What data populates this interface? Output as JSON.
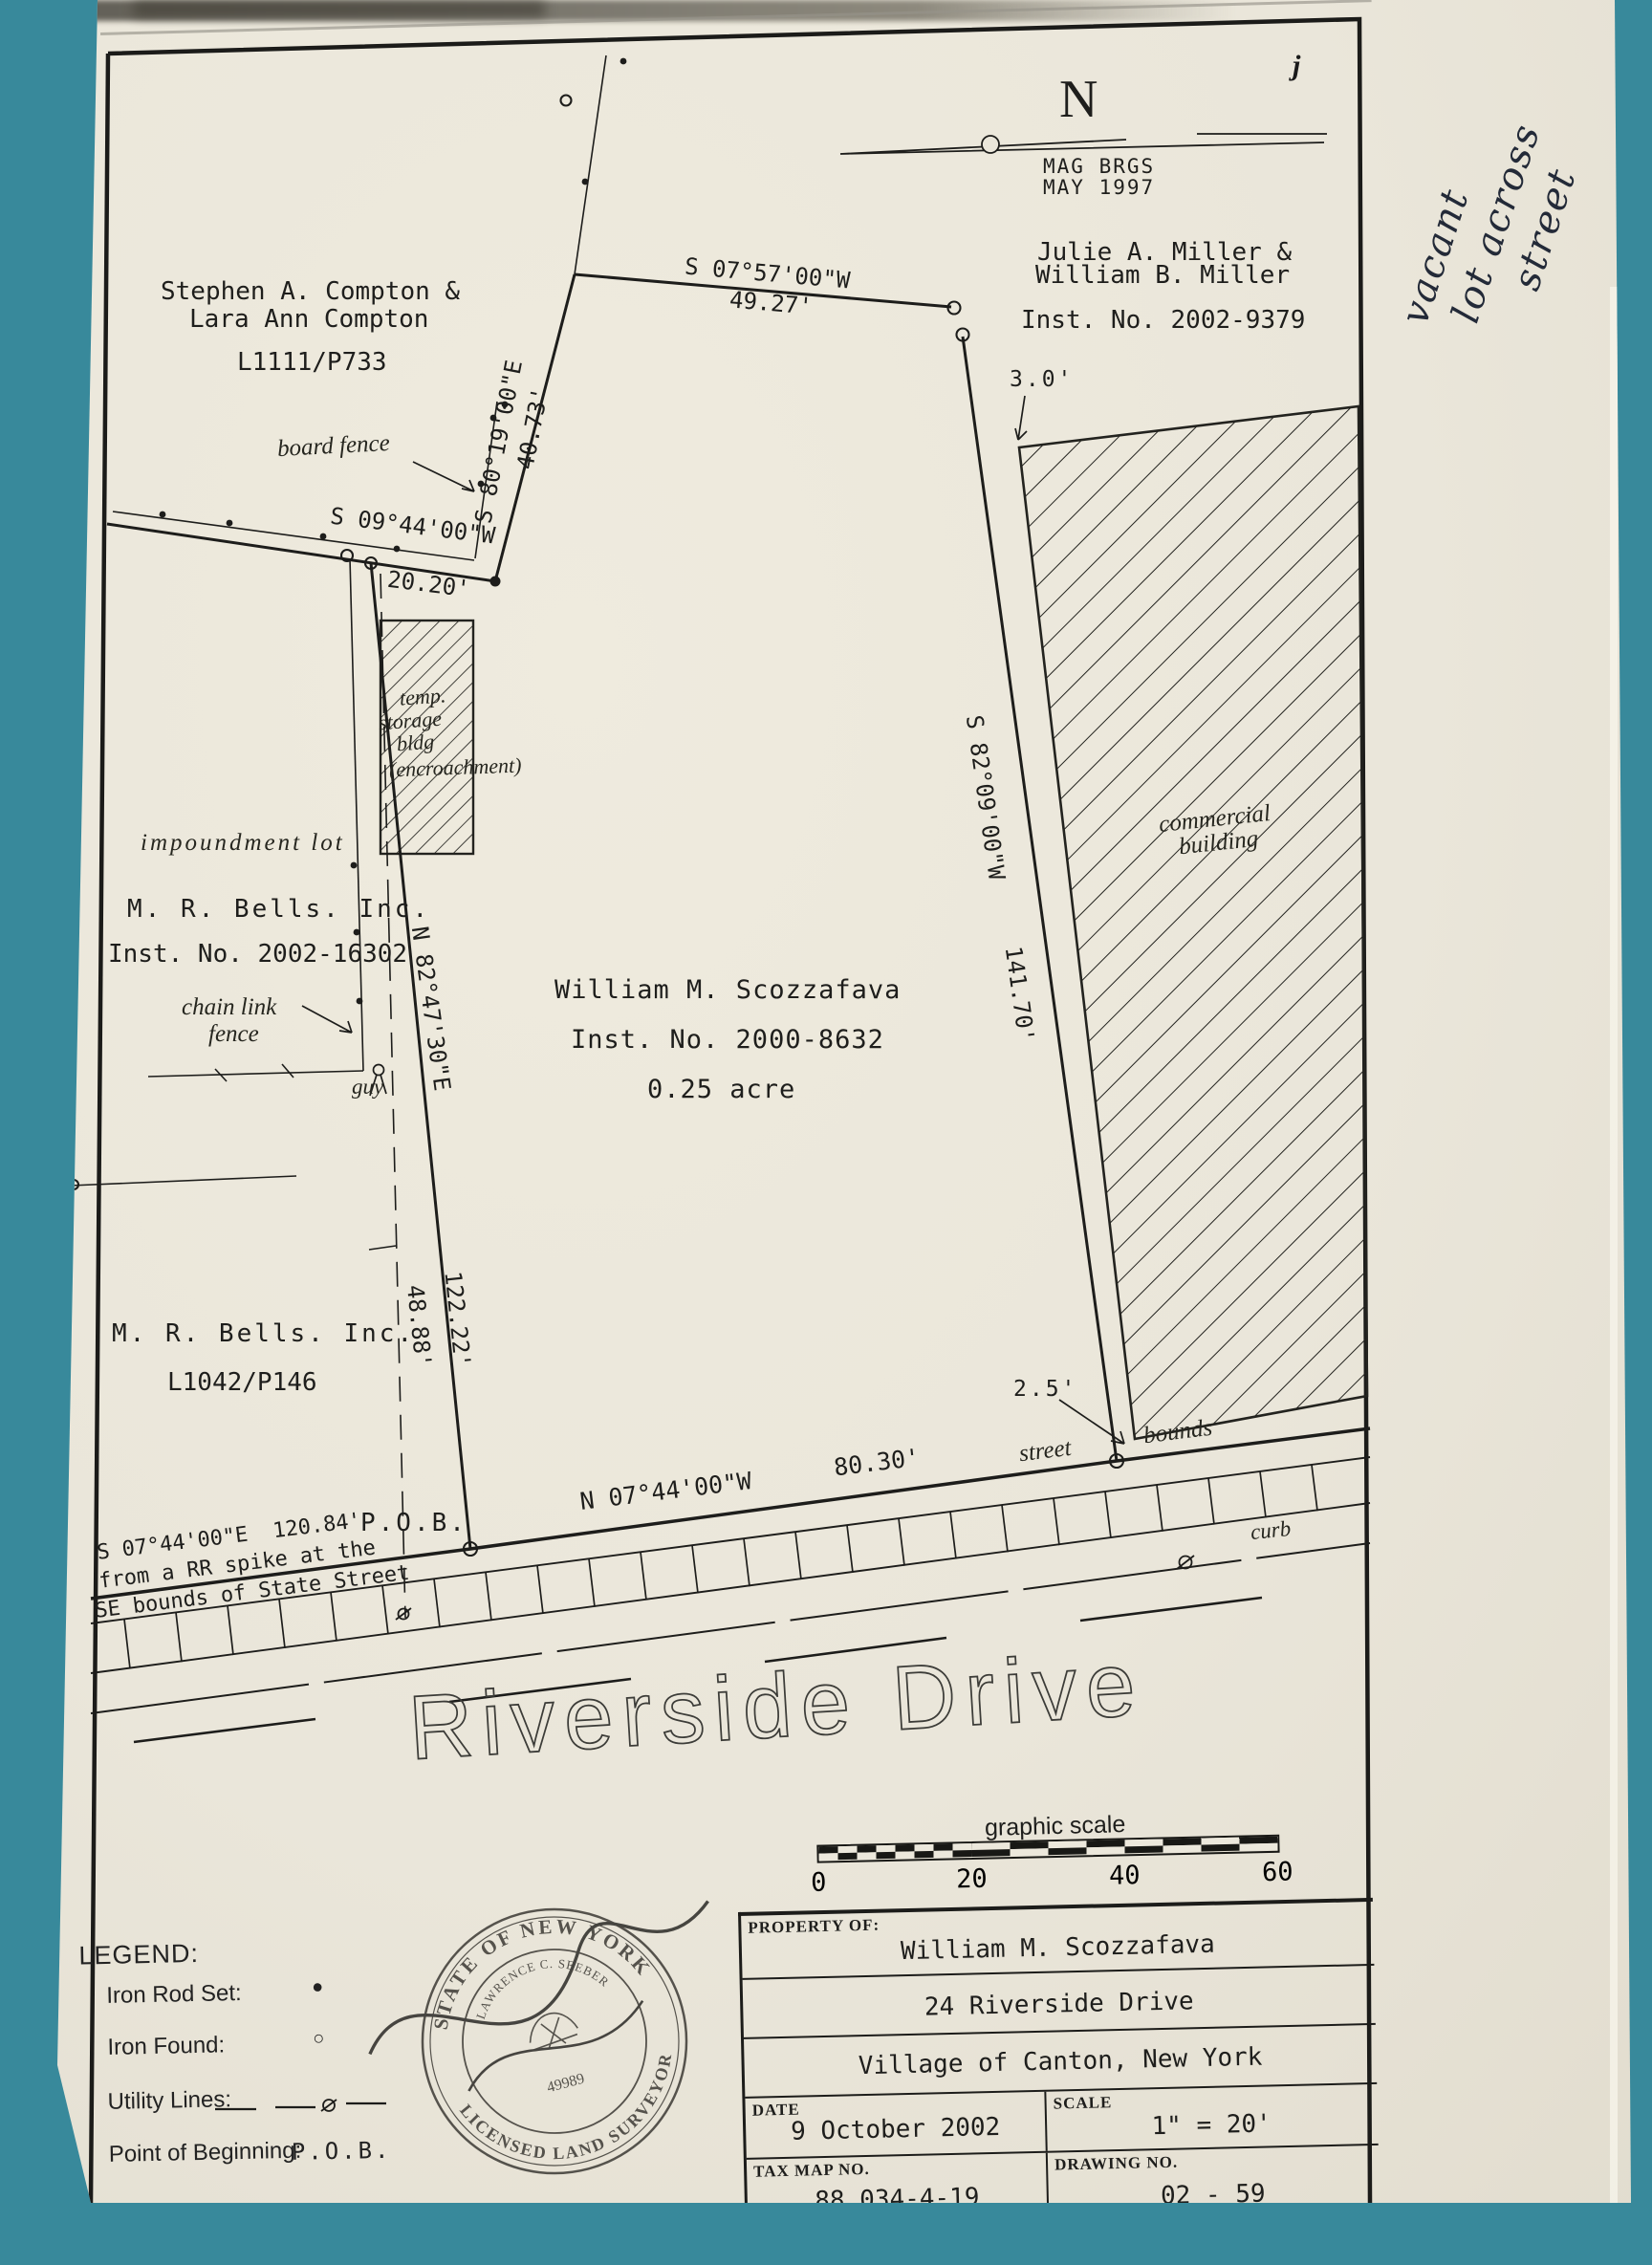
{
  "north": {
    "letter": "N",
    "mag_line1": "MAG BRGS",
    "mag_line2": "MAY 1997"
  },
  "parcels": {
    "compton": {
      "line1": "Stephen A. Compton &",
      "line2": "Lara Ann Compton",
      "deed": "L1111/P733"
    },
    "miller": {
      "line1": "Julie A. Miller &",
      "line2": "William B. Miller",
      "inst": "Inst. No. 2002-9379"
    },
    "bells_north": {
      "label": "impoundment lot",
      "name": "M. R. Bells. Inc.",
      "inst": "Inst. No. 2002-16302"
    },
    "bells_south": {
      "name": "M. R. Bells. Inc.",
      "deed": "L1042/P146"
    },
    "subject": {
      "owner": "William M. Scozzafava",
      "inst": "Inst. No. 2000-8632",
      "area": "0.25 acre"
    }
  },
  "bearings": {
    "s0944": "S 09°44'00\"W",
    "d2020": "20.20'",
    "s8019": "S 80°19'00\"E",
    "d4073": "40.73'",
    "s0757": "S 07°57'00\"W",
    "d4927": "49.27'",
    "s8209": "S 82°09'00\"W",
    "d14170": "141.70'",
    "n8247": "N 82°47'30\"E",
    "n0744": "N 07°44'00\"W",
    "d8030": "80.30'",
    "d12222": "122.22'",
    "d4888": "48.88'",
    "offset30": "3.0'",
    "offset25": "2.5'"
  },
  "features": {
    "board_fence": "board fence",
    "temp1": "temp.",
    "temp2": "storage",
    "temp3": "bldg",
    "temp4": "(encroachment)",
    "chain1": "chain link",
    "chain2": "fence",
    "guy": "guy",
    "commercial1": "commercial",
    "commercial2": "building",
    "street": "street",
    "bounds": "bounds",
    "curb": "curb",
    "pob": "P.O.B."
  },
  "tie": {
    "line1": "S 07°44'00\"E  120.84'",
    "line2": "from a RR spike at the",
    "line3": "SE bounds of State Street"
  },
  "street_name": "Riverside Drive",
  "scale_bar": {
    "title": "graphic scale",
    "ticks": [
      "0",
      "20",
      "40",
      "60"
    ]
  },
  "legend": {
    "title": "LEGEND:",
    "iron_rod": "Iron Rod Set:",
    "iron_found": "Iron Found:",
    "utility": "Utility Lines:",
    "pob_label": "Point of Beginning:",
    "pob_value": "P.O.B."
  },
  "stamp": {
    "arc_top": "STATE OF NEW YORK",
    "arc_bottom": "LICENSED LAND SURVEYOR",
    "name": "LAWRENCE C. SEEBER",
    "number": "49989"
  },
  "title_block": {
    "property_of": "PROPERTY OF:",
    "owner": "William M. Scozzafava",
    "address": "24 Riverside Drive",
    "city": "Village of Canton, New York",
    "date_label": "DATE",
    "date": "9 October 2002",
    "scale_label": "SCALE",
    "scale": "1\" = 20'",
    "tax_label": "TAX MAP NO.",
    "tax": "88.034-4-19",
    "drawing_label": "DRAWING NO.",
    "drawing": "02 - 59"
  },
  "handwriting": {
    "line1": "vacant",
    "line2": "lot across",
    "line3": "street"
  },
  "ink_mark": "j",
  "colors": {
    "background": "#38899b",
    "paper": "#eae6da",
    "ink": "#1d1d1b"
  }
}
